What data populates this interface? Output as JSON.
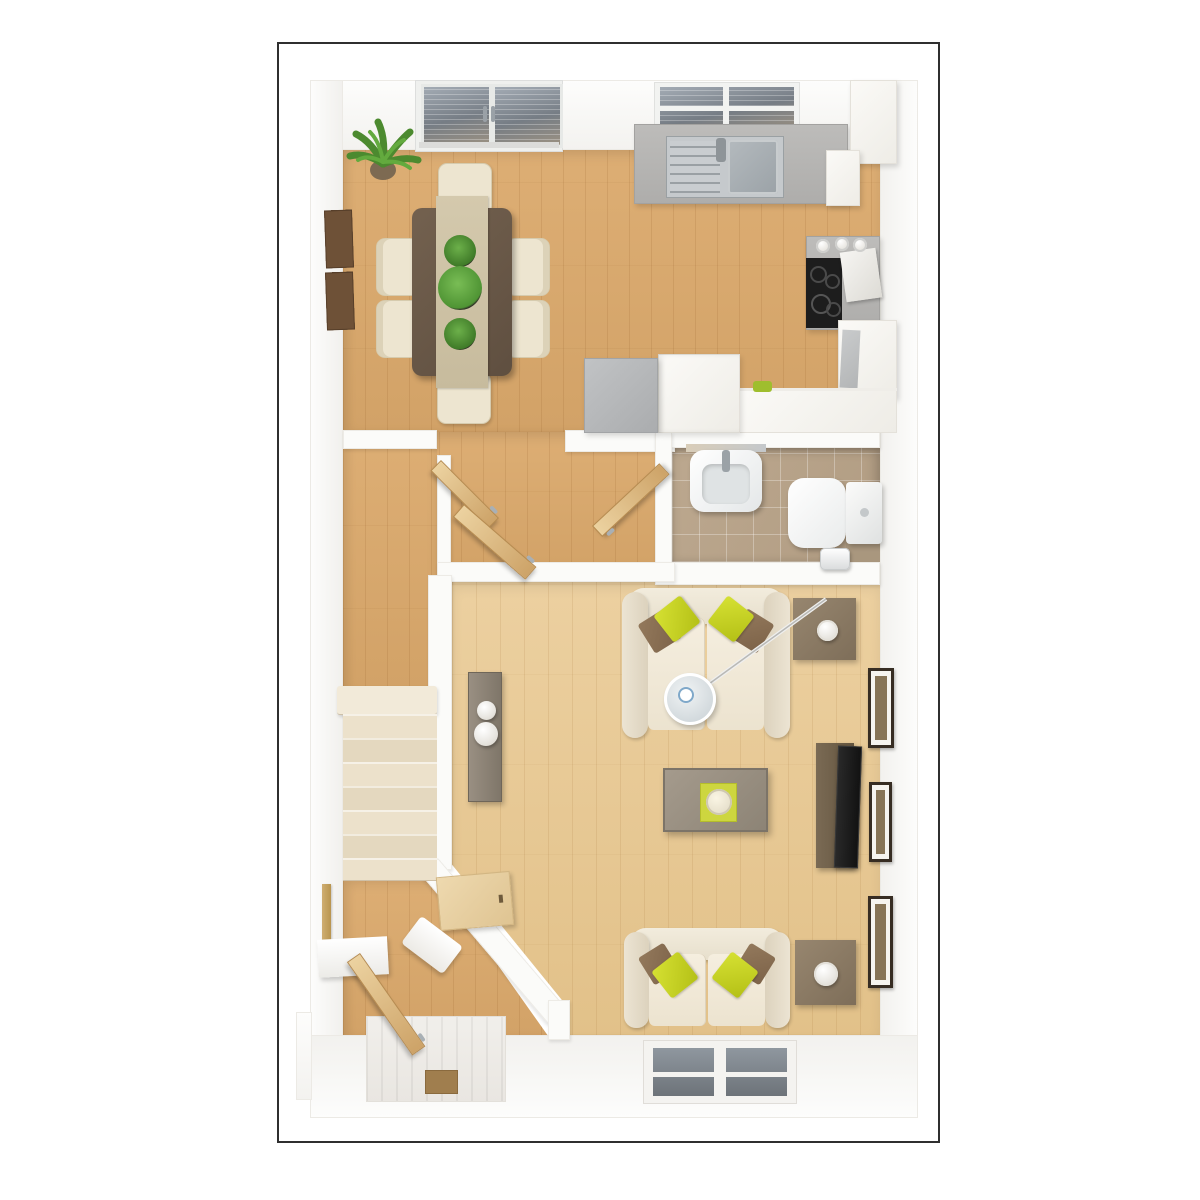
{
  "image_type": "3d-floor-plan-render-top-view",
  "palette": {
    "frame_border": "#2f2f2f",
    "background": "#ffffff",
    "wall_white": "#fbfbf9",
    "wood_warm": "#d8a76e",
    "wood_light": "#e7c993",
    "stair_cream": "#e8ddc5",
    "tile_taupe": "#b7a389",
    "accent_lime": "#c9d52a",
    "sofa_cream": "#efe8d9",
    "cushion_brown": "#8a7156",
    "kitchen_counter_gray": "#b7b6b4",
    "hob_black": "#1d1d1d",
    "glass_blue_gray": "#8f98a2",
    "dining_table_wood": "#6b5948",
    "runner_beige": "#cfc3a6",
    "plant_green": "#57a03a",
    "door_wood": "#d9b276"
  },
  "rooms": [
    {
      "name": "dining-area",
      "floor": "warm-wood"
    },
    {
      "name": "kitchen",
      "floor": "warm-wood"
    },
    {
      "name": "hallway",
      "floor": "warm-wood"
    },
    {
      "name": "wc",
      "floor": "taupe-tile"
    },
    {
      "name": "living-room",
      "floor": "light-wood"
    },
    {
      "name": "stairs-corridor",
      "floor": "cream-steps"
    },
    {
      "name": "entry-hall",
      "floor": "warm-wood"
    }
  ],
  "furniture": {
    "dining": [
      "palm-plant",
      "wall-art-panels",
      "dining-table",
      "table-runner",
      "three-plant-pots",
      "six-cream-chairs"
    ],
    "kitchen": [
      "french-doors",
      "kitchen-window",
      "sink-counter",
      "double-sink",
      "wall-cabinets",
      "hob",
      "kettle",
      "fridge",
      "peninsula-counter",
      "base-counters",
      "herb-pot"
    ],
    "wc": [
      "washbasin",
      "toilet",
      "toilet-roll-holder"
    ],
    "living": [
      "sofa-top",
      "sofa-bottom",
      "coffee-table",
      "glass-side-table",
      "arc-floor-lamp",
      "square-side-table-with-lamp-x2",
      "tv-unit",
      "tv",
      "console-with-bowls",
      "three-wall-frames",
      "window"
    ],
    "entry": [
      "front-door-open",
      "door-mat",
      "wall-shelf",
      "coat-rail",
      "desk-nook",
      "bench"
    ],
    "hall": [
      "open-door-left",
      "open-door-middle",
      "open-door-right"
    ]
  }
}
